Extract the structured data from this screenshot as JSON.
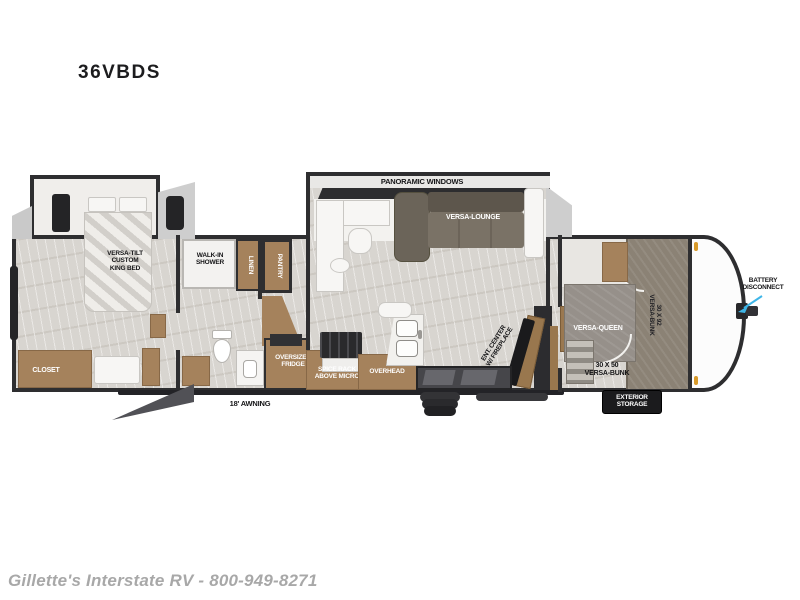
{
  "title": "36VBDS",
  "floorplan": {
    "bedroom": {
      "bed": "VERSA-TILT\nCUSTOM\nKING BED",
      "closet": "CLOSET"
    },
    "bathroom": {
      "shower": "WALK-IN\nSHOWER",
      "linen": "LINEN"
    },
    "kitchen": {
      "pantry": "PANTRY",
      "fridge": "OVERSIZED\nFRIDGE",
      "spice_rack": "SPICE RACK\nABOVE MICRO",
      "overhead": "OVERHEAD"
    },
    "living": {
      "windows": "PANORAMIC WINDOWS",
      "lounge": "VERSA-LOUNGE",
      "ent_center": "ENT. CENTER\nW/ FIREPLACE"
    },
    "bunkhouse": {
      "queen": "VERSA-QUEEN",
      "bunk_30x50": "30 X 50\nVERSA-BUNK",
      "bunk_30x92": "30 X 92\nVERSA-BUNK"
    },
    "exterior": {
      "awning": "18' AWNING",
      "storage": "EXTERIOR\nSTORAGE",
      "battery": "BATTERY\nDISCONNECT"
    }
  },
  "footer": {
    "dealer_line": "Gillette's Interstate RV - 800-949-8271"
  },
  "colors": {
    "wall": "#2e2e30",
    "cabinet_wood": "#a5825c",
    "floor": "#d8d5d0",
    "sofa": "#746c60",
    "bunk_fabric": "#8b8275",
    "arrow_accent": "#3fb6e8",
    "clearance_marker": "#d89a2a",
    "storage_box": "#1b1b1d",
    "footer_text": "#a8a8a8"
  }
}
